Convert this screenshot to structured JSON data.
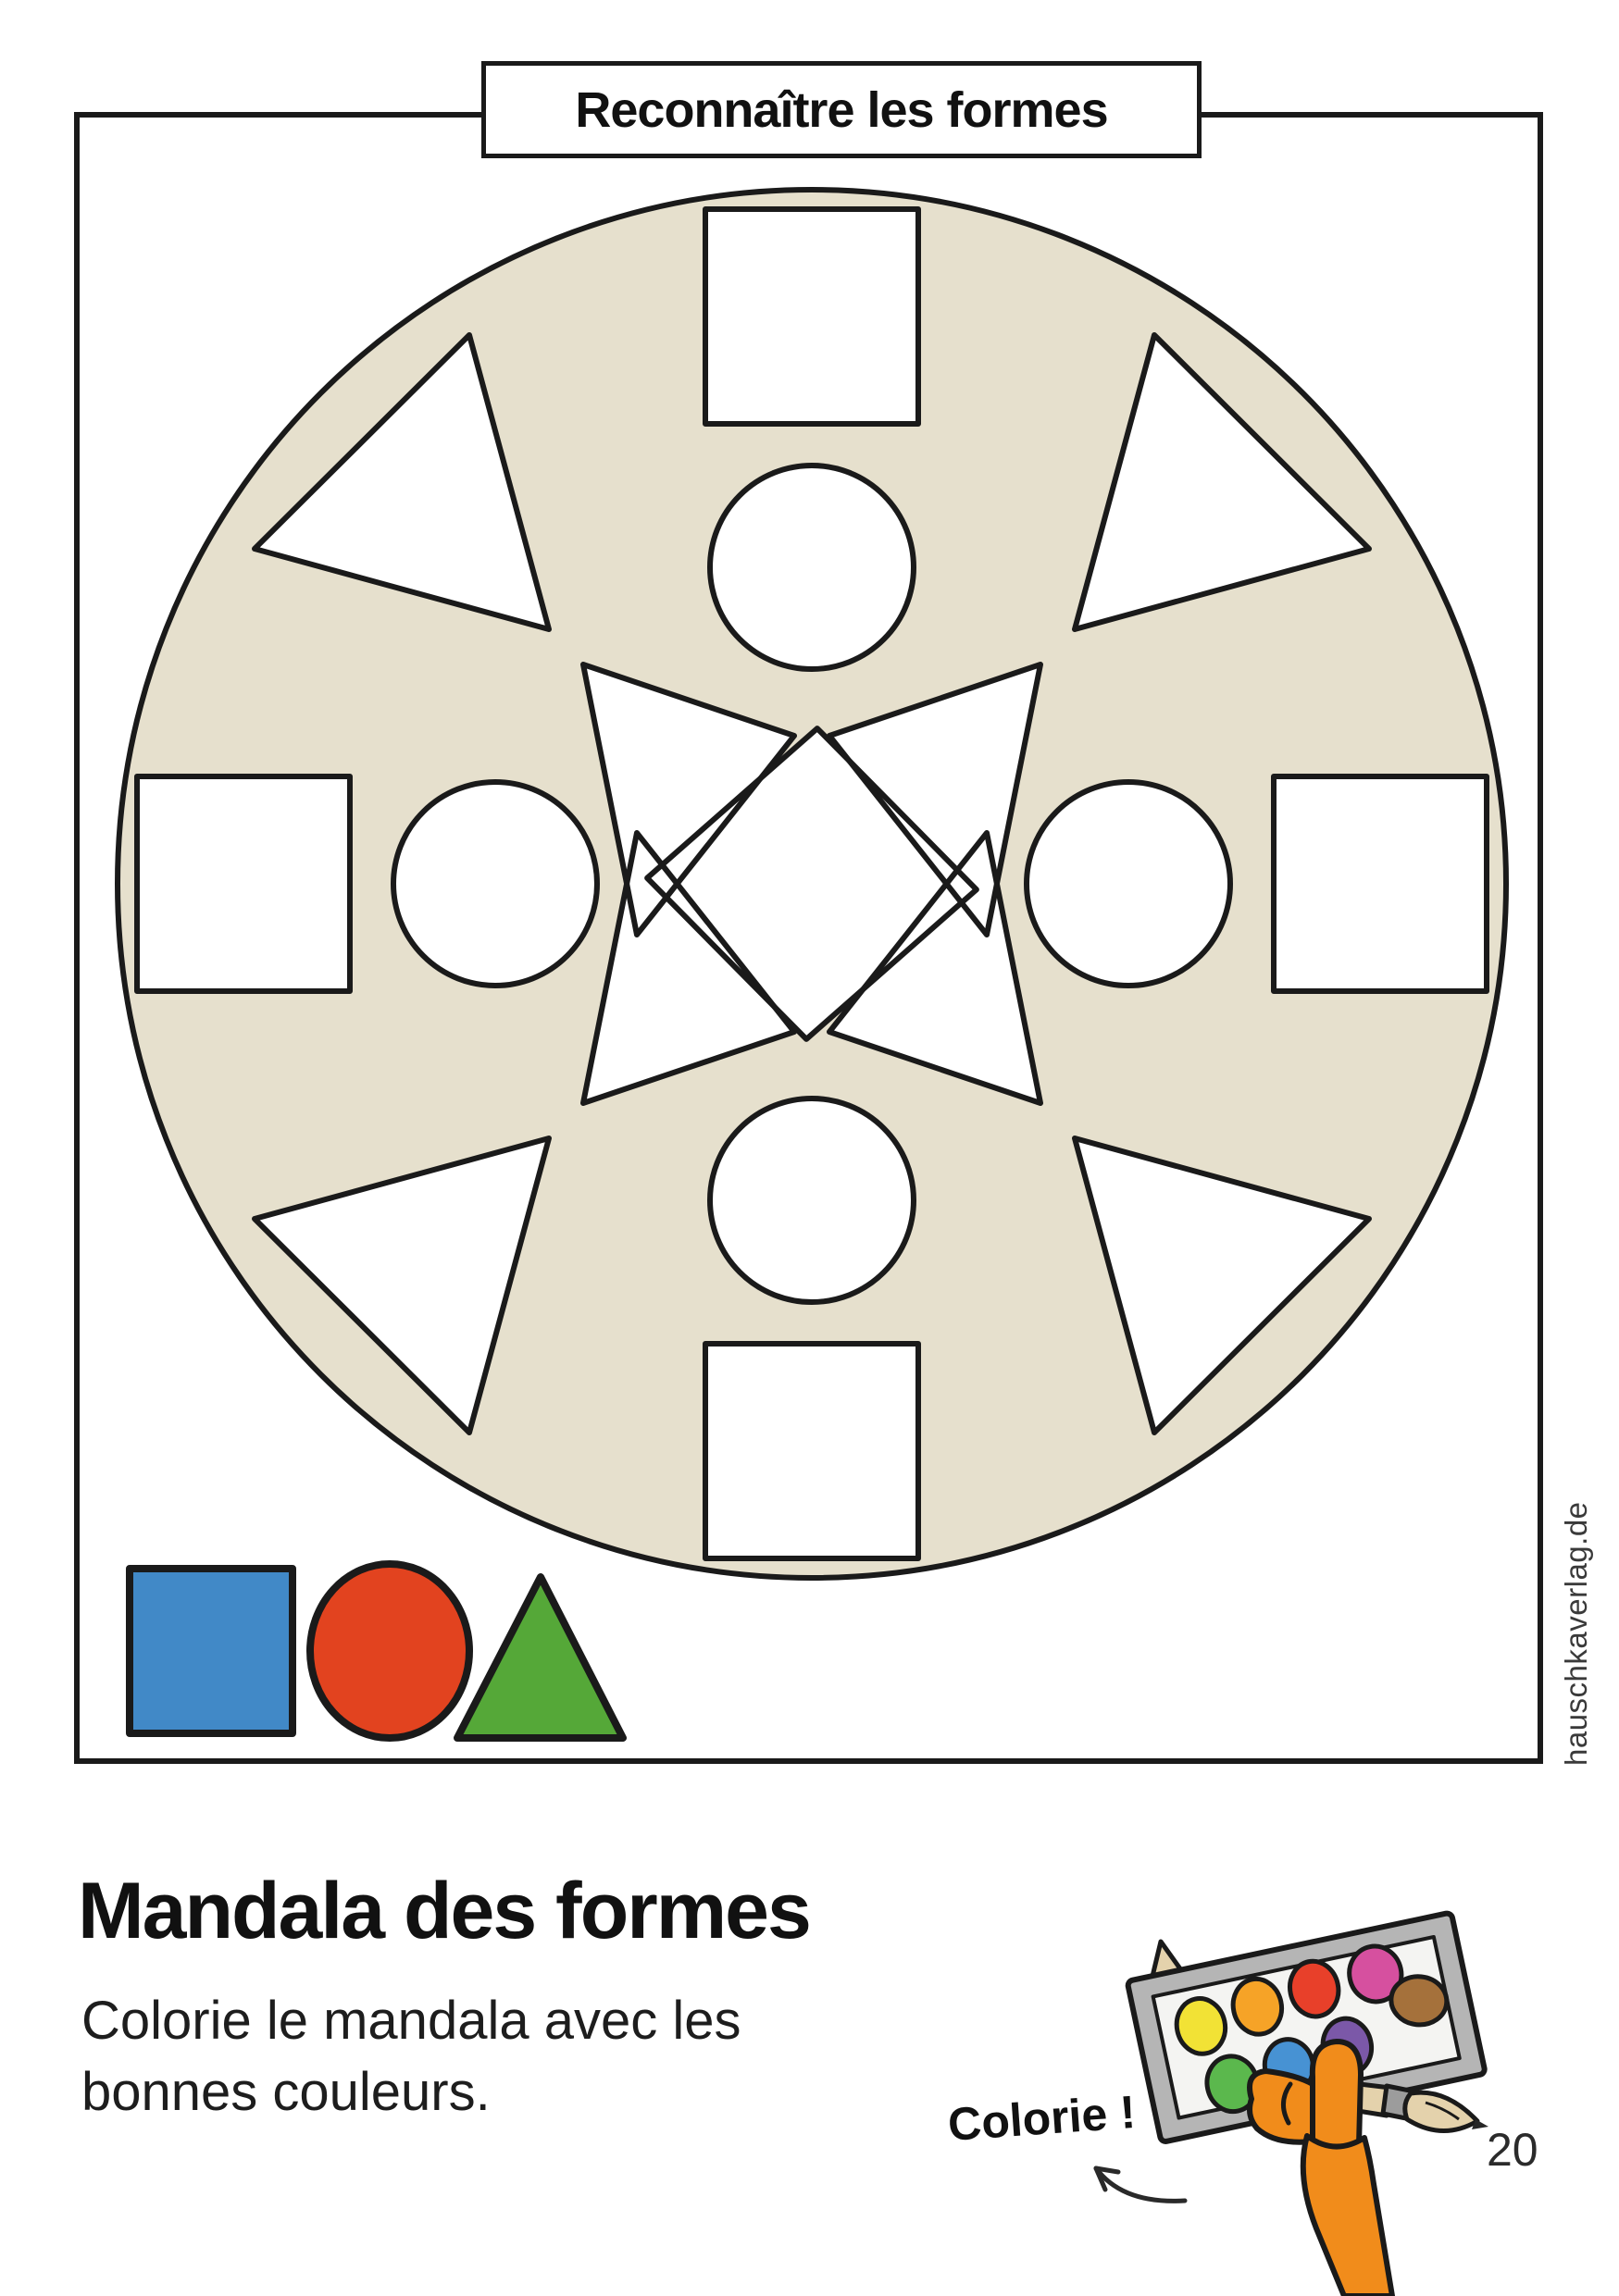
{
  "page": {
    "number": "20",
    "watermark": "hauschkaverlag.de",
    "background": "#ffffff"
  },
  "header": {
    "title": "Reconnaître les formes"
  },
  "mandala": {
    "disc_fill": "#e6e0cd",
    "outline": "#1a1a1a",
    "shape_fill": "#ffffff"
  },
  "legend": {
    "square_color": "#4189c7",
    "circle_color": "#e2431f",
    "triangle_color": "#55a838",
    "outline": "#1a1a1a"
  },
  "footer": {
    "heading": "Mandala des formes",
    "instruction_line1": "Colorie le mandala avec les",
    "instruction_line2": "bonnes couleurs.",
    "callout": "Colorie !"
  },
  "illustration": {
    "arm_color": "#f18c1b",
    "palette_frame": "#b5b5b5",
    "palette_inner": "#f4f4f2",
    "brush_wood": "#e4d2ac",
    "brush_metal": "#9c9c9c",
    "brush_dark_tip": "#262626",
    "paints": {
      "yellow": "#f2e235",
      "orange": "#f6a327",
      "red": "#e8402a",
      "magenta": "#d6509f",
      "brown": "#a5713b",
      "green": "#5bb84d",
      "blue": "#4792d3",
      "purple": "#7b58a8"
    }
  }
}
